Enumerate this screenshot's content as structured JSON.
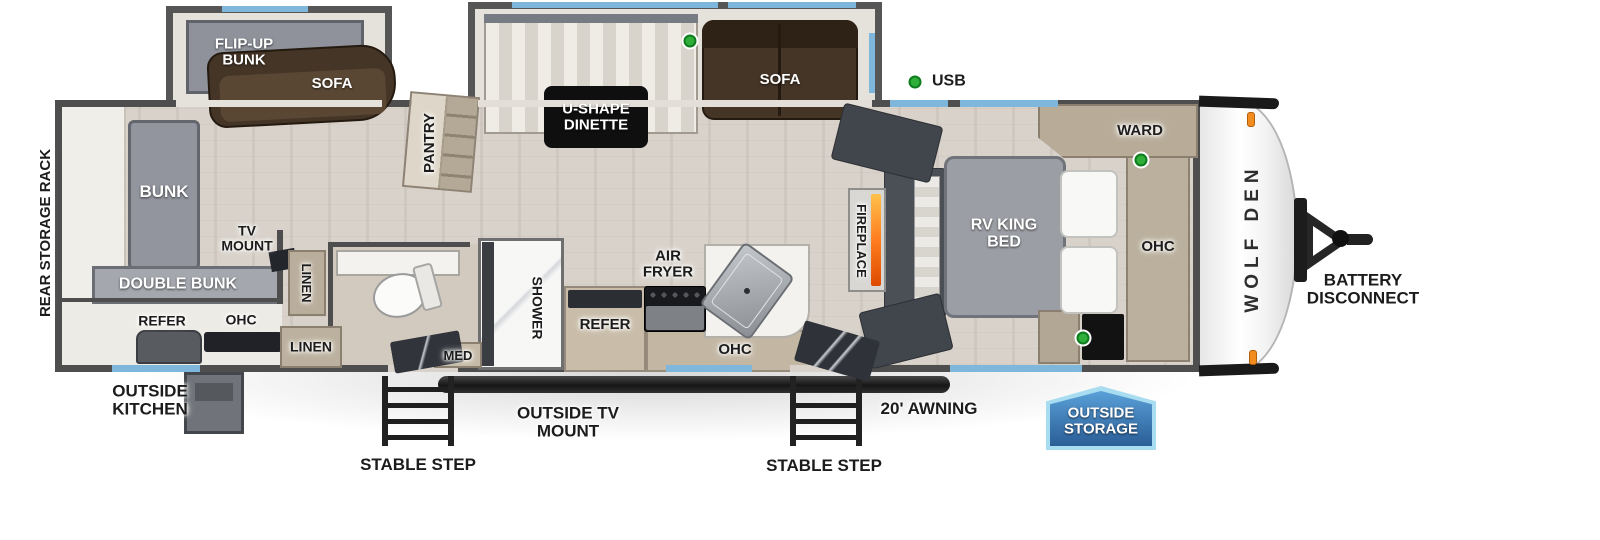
{
  "image_type": "RV travel trailer floorplan (top-down)",
  "brand_logo": "WOLF DEN",
  "legend": {
    "usb_label": "USB"
  },
  "exterior_labels": {
    "rear_storage_rack": "REAR STORAGE RACK",
    "outside_kitchen": "OUTSIDE KITCHEN",
    "stable_step_left": "STABLE STEP",
    "outside_tv_mount": "OUTSIDE TV MOUNT",
    "stable_step_right": "STABLE STEP",
    "awning": "20' AWNING",
    "outside_storage": "OUTSIDE STORAGE",
    "battery_disconnect": "BATTERY DISCONNECT"
  },
  "room_labels": {
    "flip_up_bunk": "FLIP-UP BUNK",
    "sofa_bunkhouse": "SOFA",
    "bunk": "BUNK",
    "double_bunk": "DOUBLE BUNK",
    "tv_mount": "TV MOUNT",
    "refer_outside_kitchen": "REFER",
    "ohc_outside_kitchen": "OHC",
    "linen_upper": "LINEN",
    "linen_lower": "LINEN",
    "pantry": "PANTRY",
    "u_shape_dinette": "U-SHAPE DINETTE",
    "sofa_living": "SOFA",
    "med": "MED",
    "shower": "SHOWER",
    "refer_kitchen": "REFER",
    "air_fryer": "AIR FRYER",
    "ohc_kitchen": "OHC",
    "fireplace": "FIREPLACE",
    "rv_king_bed": "RV KING BED",
    "ward": "WARD",
    "ohc_bedroom": "OHC"
  },
  "colors": {
    "wall": "#4e4e4e",
    "floor_wood": "#d8d2ca",
    "window_blue": "#7fb6dc",
    "sofa_brown": "#453527",
    "cabinet_tan": "#b9ad9b",
    "usb_green": "#2fae3a",
    "flame_orange": "#f2731d",
    "storage_badge_blue": "#2f6ca5"
  }
}
